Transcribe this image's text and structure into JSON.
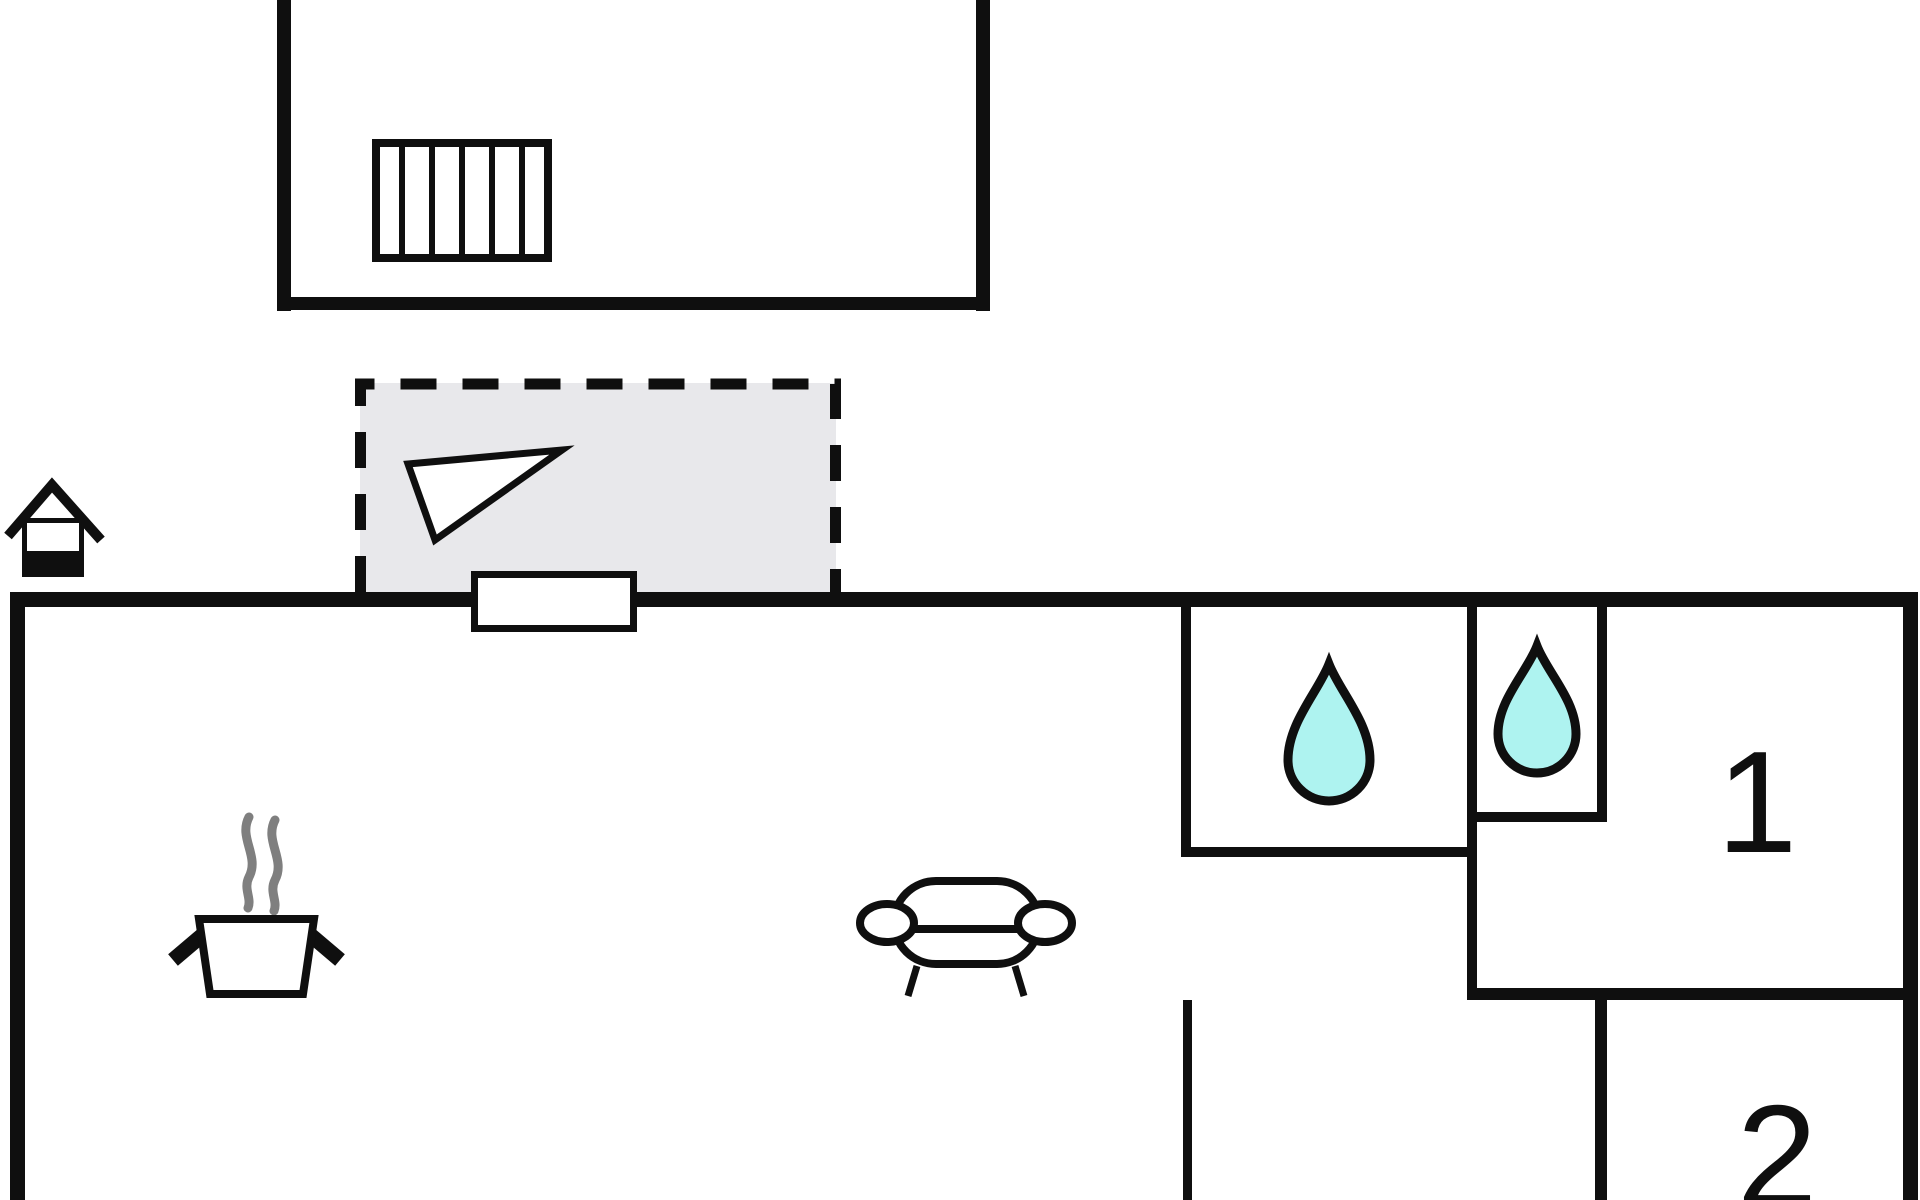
{
  "colors": {
    "wall": "#0f0f0f",
    "terrace_fill": "#e8e8eb",
    "drop_fill": "#aef3f0",
    "steam": "#7f7f7f",
    "paper": "#ffffff"
  },
  "rooms": {
    "bedroom1": {
      "label": "1"
    },
    "bedroom2": {
      "label": "2"
    }
  },
  "icons": {
    "stairs": "stairs-icon",
    "direction_arrow": "direction-triangle-icon",
    "entrance_house": "house-icon",
    "cooking_pot": "cooking-pot-icon",
    "sofa": "sofa-icon",
    "water_drop_bathroom1": "water-drop-icon",
    "water_drop_bathroom2": "water-drop-icon"
  }
}
